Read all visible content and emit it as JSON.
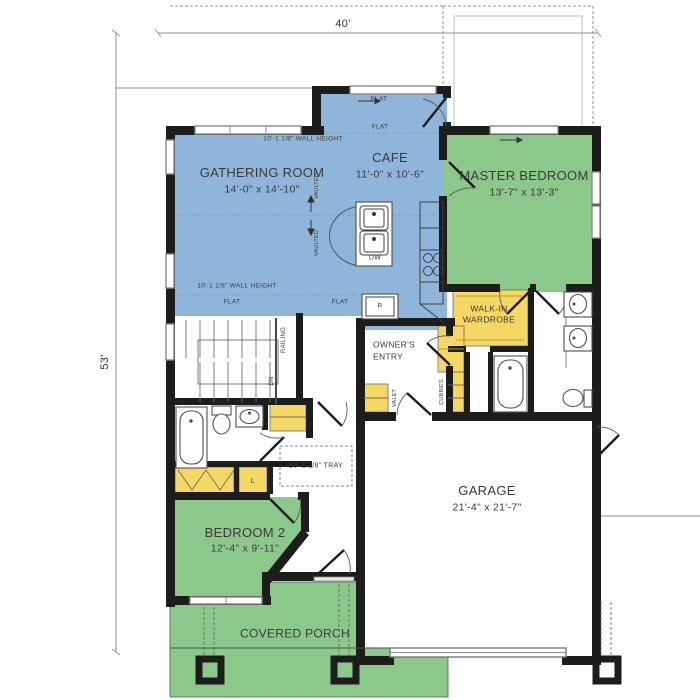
{
  "palette": {
    "room_blue": "#8fb6da",
    "room_green": "#8dc88b",
    "cabinet_yellow": "#f5d763",
    "wall_black": "#1d1d1b",
    "window_gray": "#8a8a8a",
    "dim_gray": "#909090",
    "text_dark": "#3a3a3a",
    "fixture_gray": "#555555"
  },
  "dimensions": {
    "overall_width": "40'",
    "overall_depth": "53'"
  },
  "rooms": {
    "gathering": {
      "name": "GATHERING ROOM",
      "dims": "14'-0\" x 14'-10\""
    },
    "cafe": {
      "name": "CAFE",
      "dims": "11'-0\" x 10'-6\""
    },
    "master": {
      "name": "MASTER BEDROOM",
      "dims": "13'-7\" x 13'-3\""
    },
    "bedroom2": {
      "name": "BEDROOM 2",
      "dims": "12'-4\" x 9'-11\""
    },
    "garage": {
      "name": "GARAGE",
      "dims": "21'-4\" x 21'-7\""
    },
    "porch": {
      "name": "COVERED PORCH"
    },
    "wardrobe": {
      "line1": "WALK-IN",
      "line2": "WARDROBE"
    },
    "owners_entry": {
      "line1": "OWNER'S",
      "line2": "ENTRY"
    }
  },
  "ceiling_notes": {
    "wall_height_top": "10'-1 1/8\" WALL HEIGHT",
    "wall_height_bottom": "10'-1 1/8\" WALL HEIGHT",
    "tray": "10'-1 1/8\" TRAY",
    "flat_cafe": "FLAT",
    "flat_top": "FLAT",
    "flat_bottom_left": "FLAT",
    "flat_bottom_mid": "FLAT",
    "vaulted_upper": "VAULTED",
    "vaulted_lower": "VAULTED"
  },
  "stairs": {
    "railing": "RAILING",
    "down": "DN"
  },
  "fixtures": {
    "dishwasher": "DW",
    "refrigerator": "R",
    "valet": "VALET",
    "cubbies": "CUBBIES",
    "linen": "L"
  }
}
